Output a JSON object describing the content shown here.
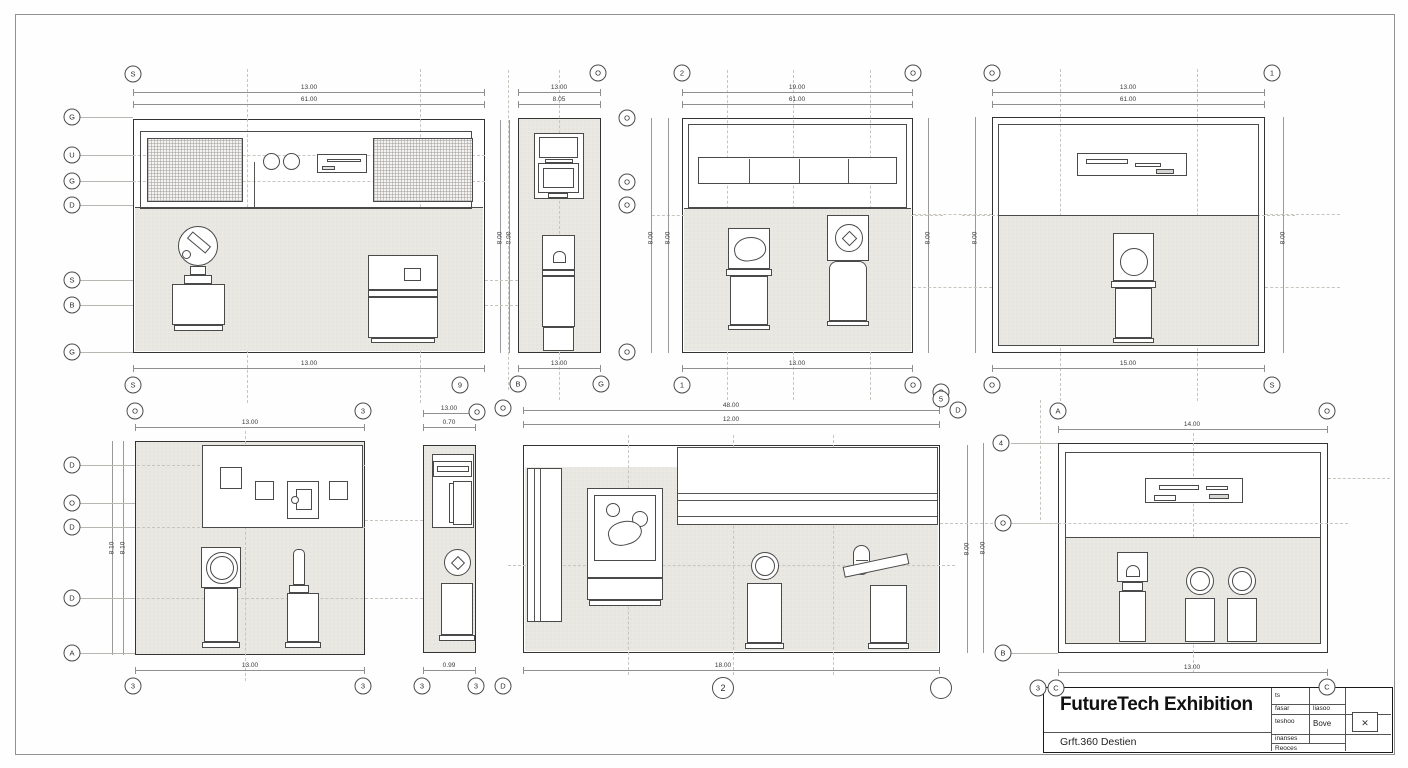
{
  "sheet": {
    "background": "#fefefe",
    "border_color": "#8f8f8f",
    "panel_fill": "#eae8e3",
    "line_color": "#4a4a4a"
  },
  "title_block": {
    "title": "FutureTech Exhibition",
    "subtitle": "Grft.360 Destien",
    "table": {
      "r1c1": "ts",
      "r2c1": "fasar",
      "r2c2": "liasoo",
      "r3c1": "teshoo",
      "r3c2": "Bove",
      "r4c1": "inanses",
      "r5c1": "Reoces"
    },
    "stamp_glyph": "✕"
  },
  "bubbles": {
    "p1_t1": "S",
    "p1_l1": "G",
    "p1_l2": "U",
    "p1_l3": "G",
    "p1_l4": "D",
    "p1_l5": "S",
    "p1_l6": "B",
    "p1_l7": "G",
    "p1_b1": "S",
    "p1_b2": "9",
    "p2_t1": "O",
    "p2_r1": "O",
    "p2_r2": "O",
    "p2_r3": "O",
    "p2_r4": "O",
    "p2_b1": "B",
    "p2_b2": "G",
    "p3_t1": "2",
    "p3_t2": "O",
    "p3_b1": "1",
    "p3_b2": "O",
    "p3_b3": "O",
    "p4_t1": "O",
    "p4_t2": "1",
    "p4_b1": "O",
    "p4_b2": "S",
    "p5_t1": "O",
    "p5_t2": "3",
    "p5_l1": "D",
    "p5_l2": "O",
    "p5_l3": "D",
    "p5_l4": "D",
    "p5_l5": "A",
    "p5_b1": "3",
    "p5_b2": "3",
    "p6_t1": "O",
    "p6_b1": "3",
    "p6_b2": "3",
    "p6_b3": "D",
    "p7_tl": "O",
    "p7_t1": "5",
    "p7_t2": "D",
    "p7_b1": "2",
    "p7_b2": "",
    "p8_t1": "A",
    "p8_t2": "O",
    "p8_l1": "4",
    "p8_l2": "O",
    "p8_l3": "B",
    "p8_b1": "3",
    "p8_b2": "C",
    "p8_b3": "C"
  },
  "dims": {
    "p1_w1": "13.00",
    "p1_w2": "61.00",
    "p1_wb": "13.00",
    "p1_h": "8.00",
    "p2_w1": "13.00",
    "p2_w2": "8.05",
    "p2_wb": "13.00",
    "p2_h1": "8.00",
    "p2_h2": "8.00",
    "p3_w1": "19.00",
    "p3_w2": "61.00",
    "p3_wb": "13.00",
    "p3_h1": "8.00",
    "p3_h2": "8.00",
    "p4_w1": "13.00",
    "p4_w2": "61.00",
    "p4_wb": "15.00",
    "p4_h1": "8.00",
    "p4_h2": "8.00",
    "p5_w1": "13.00",
    "p5_wb": "13.00",
    "p5_h1": "8.10",
    "p5_h2": "8.10",
    "p6_w1": "13.00",
    "p6_w2": "0.70",
    "p6_wb": "0.99",
    "p7_w1": "48.00",
    "p7_w2": "12.00",
    "p7_wb": "18.00",
    "p7_h": "8.00",
    "p8_w1": "14.00",
    "p8_wb": "13.00",
    "p8_h": "8.00"
  }
}
